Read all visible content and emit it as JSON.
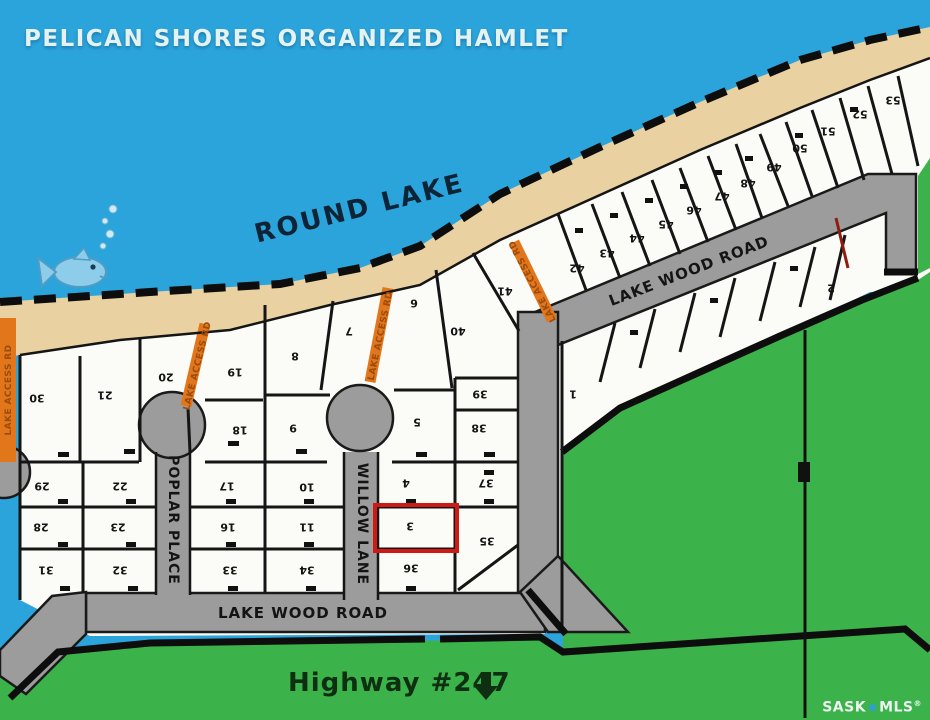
{
  "title": "PELICAN SHORES ORGANIZED HAMLET",
  "lake": {
    "name_label": "ROUND LAKE"
  },
  "roads": {
    "lake_wood_road_upper_label": "LAKE WOOD ROAD",
    "lake_wood_road_lower_label": "LAKE WOOD ROAD",
    "poplar_place_label": "POPLAR PLACE",
    "willow_lane_label": "WILLOW LANE",
    "lake_access_label": "LAKE ACCESS RD"
  },
  "highway": {
    "label": "Highway #247"
  },
  "watermark": {
    "sask": "SASK",
    "mls": "MLS",
    "registered": "®"
  },
  "highlighted_lot": "3",
  "colors": {
    "water": "#2ba4dc",
    "beach": "#ead1a1",
    "grass": "#3cb24b",
    "road": "#9c9c9c",
    "access_road": "#e2761b",
    "highlight": "#cf1a14",
    "title_text": "#e4f2f2",
    "lake_text": "#0d2436",
    "mls_dot": "#2e9fd0"
  },
  "lots": [
    {
      "label": "30",
      "x": 37,
      "y": 398
    },
    {
      "label": "21",
      "x": 105,
      "y": 395
    },
    {
      "label": "20",
      "x": 166,
      "y": 377
    },
    {
      "label": "19",
      "x": 235,
      "y": 372
    },
    {
      "label": "18",
      "x": 240,
      "y": 430
    },
    {
      "label": "9",
      "x": 293,
      "y": 428
    },
    {
      "label": "8",
      "x": 295,
      "y": 356
    },
    {
      "label": "7",
      "x": 349,
      "y": 331
    },
    {
      "label": "6",
      "x": 414,
      "y": 303
    },
    {
      "label": "5",
      "x": 417,
      "y": 422
    },
    {
      "label": "40",
      "x": 458,
      "y": 331
    },
    {
      "label": "39",
      "x": 480,
      "y": 394
    },
    {
      "label": "38",
      "x": 479,
      "y": 428
    },
    {
      "label": "41",
      "x": 505,
      "y": 291
    },
    {
      "label": "29",
      "x": 42,
      "y": 486
    },
    {
      "label": "22",
      "x": 120,
      "y": 486
    },
    {
      "label": "28",
      "x": 41,
      "y": 527
    },
    {
      "label": "23",
      "x": 118,
      "y": 527
    },
    {
      "label": "31",
      "x": 46,
      "y": 570
    },
    {
      "label": "32",
      "x": 120,
      "y": 570
    },
    {
      "label": "17",
      "x": 227,
      "y": 486
    },
    {
      "label": "10",
      "x": 307,
      "y": 487
    },
    {
      "label": "16",
      "x": 228,
      "y": 527
    },
    {
      "label": "11",
      "x": 307,
      "y": 527
    },
    {
      "label": "33",
      "x": 230,
      "y": 570
    },
    {
      "label": "34",
      "x": 307,
      "y": 570
    },
    {
      "label": "4",
      "x": 406,
      "y": 483
    },
    {
      "label": "37",
      "x": 486,
      "y": 483
    },
    {
      "label": "3",
      "x": 410,
      "y": 526
    },
    {
      "label": "36",
      "x": 411,
      "y": 568
    },
    {
      "label": "35",
      "x": 487,
      "y": 541
    },
    {
      "label": "1",
      "x": 573,
      "y": 394
    },
    {
      "label": "2",
      "x": 831,
      "y": 288
    },
    {
      "label": "42",
      "x": 577,
      "y": 268
    },
    {
      "label": "43",
      "x": 607,
      "y": 253
    },
    {
      "label": "44",
      "x": 637,
      "y": 238
    },
    {
      "label": "45",
      "x": 666,
      "y": 224
    },
    {
      "label": "46",
      "x": 694,
      "y": 210
    },
    {
      "label": "47",
      "x": 722,
      "y": 196
    },
    {
      "label": "48",
      "x": 748,
      "y": 183
    },
    {
      "label": "49",
      "x": 774,
      "y": 167
    },
    {
      "label": "50",
      "x": 800,
      "y": 148
    },
    {
      "label": "51",
      "x": 828,
      "y": 131
    },
    {
      "label": "52",
      "x": 860,
      "y": 114
    },
    {
      "label": "53",
      "x": 893,
      "y": 100
    }
  ]
}
